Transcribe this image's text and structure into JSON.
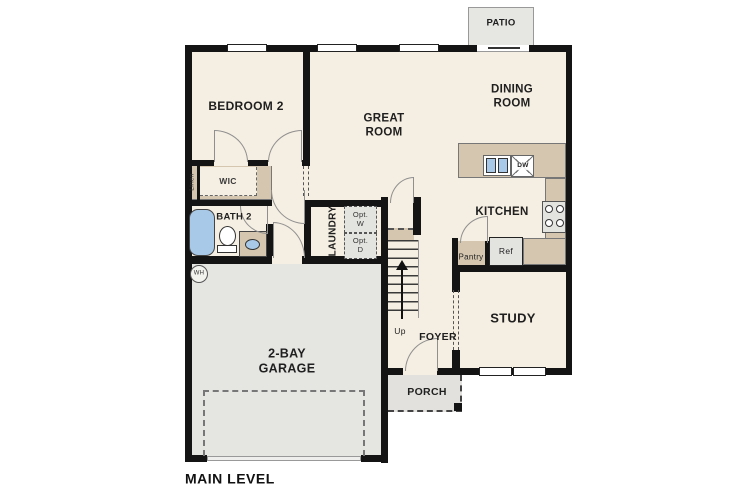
{
  "title": "MAIN LEVEL",
  "colors": {
    "floor": "#f5eee2",
    "wall": "#141414",
    "counter": "#d5c7af",
    "garage": "#e5e5e2",
    "porch": "#e2e1dd",
    "patio": "#e6e6e3",
    "blue": "#a9c9e9",
    "arc": "#8f8f8f",
    "appliance": "#e3e3e0",
    "ink": "#1f1f1f",
    "dash": "#555555"
  },
  "labels": {
    "bedroom2": "BEDROOM 2",
    "great_room": "GREAT\nROOM",
    "dining_room": "DINING\nROOM",
    "kitchen": "KITCHEN",
    "study": "STUDY",
    "foyer": "FOYER",
    "laundry": "LAUNDRY",
    "bath2": "BATH 2",
    "wic": "WIC",
    "linen": "Linen",
    "pantry": "Pantry",
    "garage": "2-BAY\nGARAGE",
    "porch": "PORCH",
    "patio": "PATIO",
    "main_level": "MAIN LEVEL",
    "up": "Up",
    "wh": "WH",
    "ref": "Ref",
    "dw": "DW",
    "opt_w": "Opt.\nW",
    "opt_d": "Opt.\nD"
  }
}
